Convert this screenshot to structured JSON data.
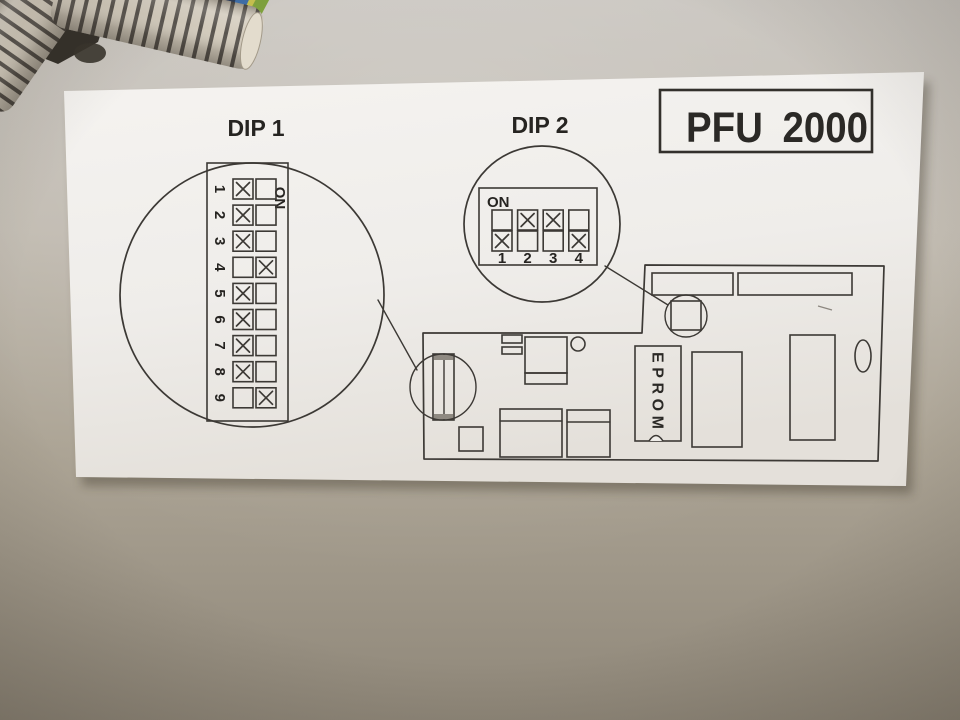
{
  "title_box": {
    "label": "PFU 2000"
  },
  "dip1": {
    "label": "DIP 1",
    "on_label": "ON",
    "switches": [
      {
        "label": "1",
        "position": "off"
      },
      {
        "label": "2",
        "position": "off"
      },
      {
        "label": "3",
        "position": "off"
      },
      {
        "label": "4",
        "position": "on"
      },
      {
        "label": "5",
        "position": "off"
      },
      {
        "label": "6",
        "position": "off"
      },
      {
        "label": "7",
        "position": "off"
      },
      {
        "label": "8",
        "position": "off"
      },
      {
        "label": "9",
        "position": "on"
      }
    ]
  },
  "dip2": {
    "label": "DIP 2",
    "on_label": "ON",
    "switches": [
      {
        "label": "1",
        "position": "off"
      },
      {
        "label": "2",
        "position": "on"
      },
      {
        "label": "3",
        "position": "on"
      },
      {
        "label": "4",
        "position": "off"
      }
    ]
  },
  "board": {
    "eprom_label": "EPROM"
  },
  "palette": {
    "wall": "#b3ab9f",
    "paper": "#f1efec",
    "ink": "#3c3935",
    "conduit_light": "#d3cbbc",
    "conduit_rib": "#55504a",
    "wire_blue": "#3e6ea8",
    "wire_green": "#7fa13d",
    "wire_yellow": "#c6c04f"
  }
}
